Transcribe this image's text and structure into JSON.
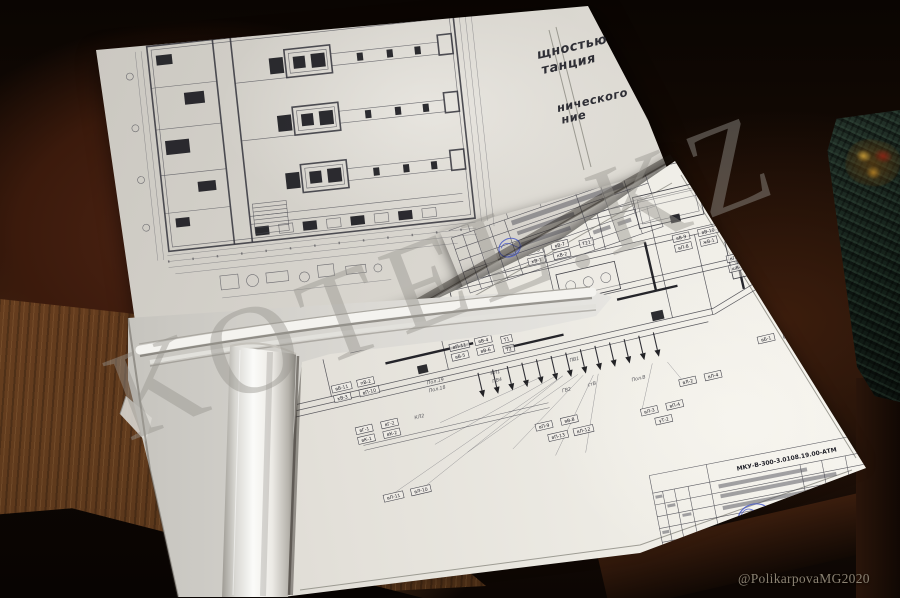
{
  "photo": {
    "watermark_text": "KOTEL.KZ",
    "credit_text": "@PolikarpovaMG2020"
  },
  "top_sheet": {
    "corner_text": {
      "line1": "щностью",
      "line2": "танция",
      "line3": "нического",
      "line4": "ние"
    }
  },
  "bottom_sheet": {
    "title_block_code": "МКУ-В-300-3.0108.19.00-АТМ",
    "scheme_tags": [
      {
        "label": "вВ-1",
        "x": 126,
        "y": 18
      },
      {
        "label": "вВ-2",
        "x": 152,
        "y": 18
      },
      {
        "label": "вВ-3",
        "x": 126,
        "y": 28
      },
      {
        "label": "вП-1",
        "x": 152,
        "y": 28
      },
      {
        "label": "вП-2",
        "x": 126,
        "y": 38
      },
      {
        "label": "уВ-3",
        "x": 152,
        "y": 38
      },
      {
        "label": "вП-3",
        "x": 222,
        "y": 40
      },
      {
        "label": "вВ-7",
        "x": 248,
        "y": 40
      },
      {
        "label": "кВ-1",
        "x": 222,
        "y": 50
      },
      {
        "label": "кВ-2",
        "x": 248,
        "y": 50
      },
      {
        "label": "Т21",
        "x": 276,
        "y": 44
      },
      {
        "label": "вВ-9",
        "x": 368,
        "y": 60
      },
      {
        "label": "вВ-10",
        "x": 394,
        "y": 60
      },
      {
        "label": "вП-8",
        "x": 368,
        "y": 70
      },
      {
        "label": "жВ-1",
        "x": 394,
        "y": 70
      },
      {
        "label": "вП-12",
        "x": 416,
        "y": 92
      },
      {
        "label": "вВ-12",
        "x": 442,
        "y": 92
      },
      {
        "label": "шВ-1",
        "x": 416,
        "y": 102
      },
      {
        "label": "шВ-2",
        "x": 442,
        "y": 102
      },
      {
        "label": "вВ-11",
        "x": 2,
        "y": 130
      },
      {
        "label": "пВ-2",
        "x": 28,
        "y": 130
      },
      {
        "label": "кВ-3",
        "x": 2,
        "y": 140
      },
      {
        "label": "вП-10",
        "x": 28,
        "y": 140
      },
      {
        "label": "вП-11",
        "x": 126,
        "y": 116
      },
      {
        "label": "вВ-4",
        "x": 152,
        "y": 116
      },
      {
        "label": "вВ-5",
        "x": 126,
        "y": 126
      },
      {
        "label": "вВ-6",
        "x": 152,
        "y": 126
      },
      {
        "label": "Т1",
        "x": 178,
        "y": 120
      },
      {
        "label": "Т2",
        "x": 178,
        "y": 130
      },
      {
        "label": "вГ-1",
        "x": 16,
        "y": 176
      },
      {
        "label": "вГ-2",
        "x": 42,
        "y": 176
      },
      {
        "label": "вК-1",
        "x": 16,
        "y": 186
      },
      {
        "label": "вК-2",
        "x": 42,
        "y": 186
      },
      {
        "label": "вЛ-11",
        "x": 28,
        "y": 248
      },
      {
        "label": "вЛ-10",
        "x": 56,
        "y": 248
      },
      {
        "label": "вП-9",
        "x": 192,
        "y": 213
      },
      {
        "label": "вВ-8",
        "x": 218,
        "y": 213
      },
      {
        "label": "вП-13",
        "x": 202,
        "y": 226
      },
      {
        "label": "вЛ-12",
        "x": 228,
        "y": 226
      },
      {
        "label": "вЛ-3",
        "x": 298,
        "y": 222
      },
      {
        "label": "вП-4",
        "x": 324,
        "y": 222
      },
      {
        "label": "уТ-2",
        "x": 310,
        "y": 234
      },
      {
        "label": "вЛ-2",
        "x": 342,
        "y": 202
      },
      {
        "label": "вЛ-4",
        "x": 368,
        "y": 202
      },
      {
        "label": "вБ-1",
        "x": 428,
        "y": 178
      },
      {
        "label": "вБ-2",
        "x": 454,
        "y": 178
      }
    ],
    "free_labels": [
      {
        "label": "Пол.19",
        "x": 96,
        "y": 150
      },
      {
        "label": "Пол.18",
        "x": 96,
        "y": 158
      },
      {
        "label": "КЛ1",
        "x": 160,
        "y": 155
      },
      {
        "label": "ПВ4",
        "x": 160,
        "y": 163
      },
      {
        "label": "ГВ2",
        "x": 226,
        "y": 188
      },
      {
        "label": "стВ",
        "x": 252,
        "y": 188
      },
      {
        "label": "Пол.В",
        "x": 296,
        "y": 193
      },
      {
        "label": "КЛ2",
        "x": 76,
        "y": 181
      },
      {
        "label": "ПВ1",
        "x": 240,
        "y": 160
      }
    ]
  },
  "colors": {
    "table_wood_dark": "#1c0f07",
    "table_wood_light": "#7d4d26",
    "paper": "#e8e6df",
    "stamp_blue": "#4053c8",
    "folder_green": "#16231b",
    "watermark_gray": "#a8a59e"
  }
}
